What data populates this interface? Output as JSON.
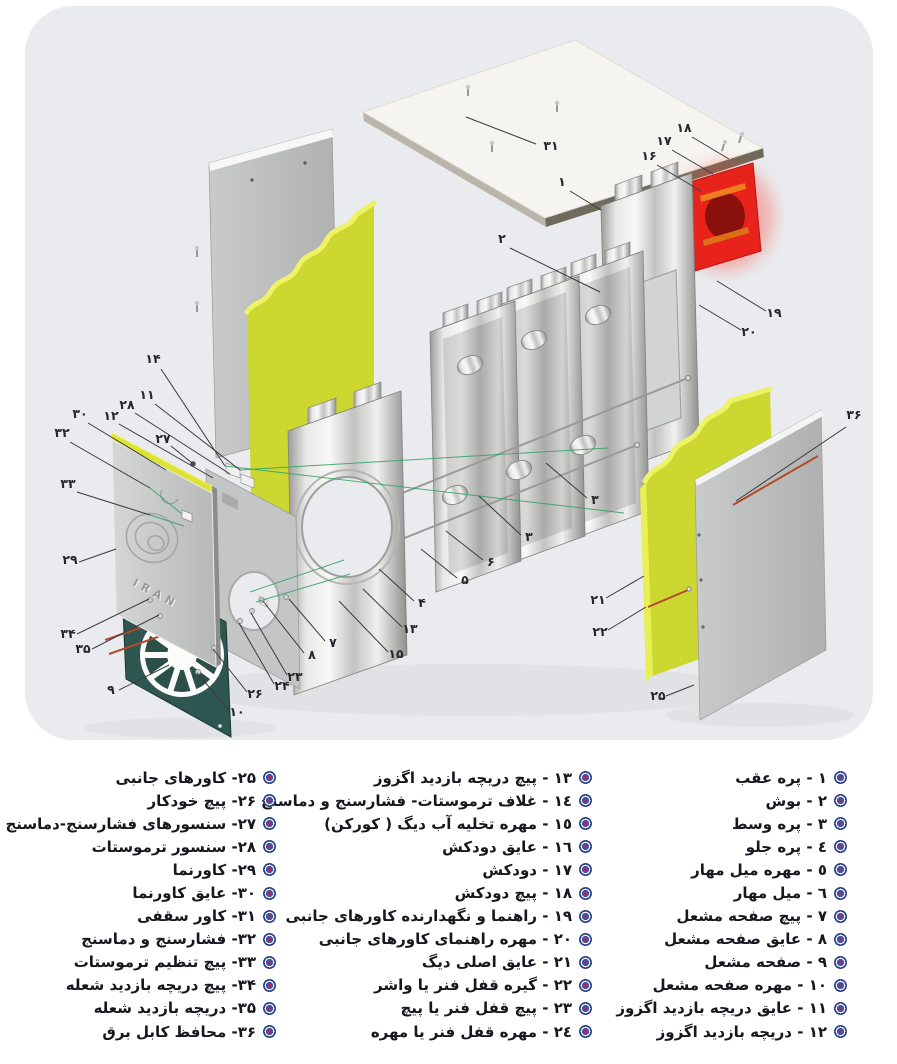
{
  "illustration": {
    "background_color": "#e9ebee",
    "logo_text": "IRAN",
    "colors": {
      "insulation_yellow": "#ccd72f",
      "insulation_highlight": "#eef263",
      "chimney_red": "#e8231b",
      "chimney_hole_dark": "#8a100c",
      "burner_plate_teal": "#2f5751",
      "panel_gray": "#bcbfbe",
      "cable_red": "#b34a28",
      "guide_green": "#2fa263",
      "callout_text": "#26262e"
    },
    "callouts": [
      {
        "n": "۳۱",
        "label": [
          551,
          150
        ],
        "line": [
          536,
          144,
          466,
          117
        ]
      },
      {
        "n": "۱۸",
        "label": [
          684,
          132
        ],
        "line": [
          692,
          137,
          729,
          159
        ]
      },
      {
        "n": "۱۷",
        "label": [
          664,
          145
        ],
        "line": [
          672,
          150,
          713,
          174
        ]
      },
      {
        "n": "۱۶",
        "label": [
          649,
          160
        ],
        "line": [
          657,
          165,
          701,
          191
        ]
      },
      {
        "n": "۱",
        "label": [
          562,
          186
        ],
        "line": [
          570,
          191,
          601,
          210
        ]
      },
      {
        "n": "۲",
        "label": [
          502,
          243
        ],
        "line": [
          510,
          248,
          600,
          292
        ]
      },
      {
        "n": "۱۹",
        "label": [
          774,
          317
        ],
        "line": [
          766,
          311,
          717,
          281
        ]
      },
      {
        "n": "۲۰",
        "label": [
          749,
          336
        ],
        "line": [
          741,
          330,
          699,
          305
        ]
      },
      {
        "n": "۳۶",
        "label": [
          854,
          419
        ],
        "line": [
          846,
          427,
          736,
          501
        ]
      },
      {
        "n": "۱۴",
        "label": [
          153,
          363
        ],
        "line": [
          161,
          369,
          225,
          466
        ]
      },
      {
        "n": "۱۱",
        "label": [
          147,
          399
        ],
        "line": [
          155,
          404,
          240,
          470
        ]
      },
      {
        "n": "۲۸",
        "label": [
          127,
          409
        ],
        "line": [
          135,
          413,
          230,
          474
        ]
      },
      {
        "n": "۱۲",
        "label": [
          111,
          420
        ],
        "line": [
          119,
          424,
          213,
          478
        ]
      },
      {
        "n": "۲۷",
        "label": [
          163,
          443
        ],
        "line": [
          171,
          446,
          192,
          463
        ]
      },
      {
        "n": "۳۰",
        "label": [
          80,
          418
        ],
        "line": [
          88,
          423,
          166,
          470
        ]
      },
      {
        "n": "۳۲",
        "label": [
          62,
          437
        ],
        "line": [
          70,
          442,
          150,
          488
        ]
      },
      {
        "n": "۳۳",
        "label": [
          68,
          488
        ],
        "line": [
          77,
          492,
          150,
          515
        ]
      },
      {
        "n": "۲۹",
        "label": [
          70,
          564
        ],
        "line": [
          79,
          562,
          116,
          549
        ]
      },
      {
        "n": "۳۴",
        "label": [
          68,
          638
        ],
        "line": [
          77,
          634,
          149,
          599
        ]
      },
      {
        "n": "۳۵",
        "label": [
          83,
          653
        ],
        "line": [
          92,
          649,
          159,
          615
        ]
      },
      {
        "n": "۹",
        "label": [
          111,
          694
        ],
        "line": [
          119,
          690,
          169,
          665
        ]
      },
      {
        "n": "۱۰",
        "label": [
          237,
          716
        ],
        "line": [
          229,
          710,
          197,
          673
        ]
      },
      {
        "n": "۲۶",
        "label": [
          255,
          698
        ],
        "line": [
          247,
          692,
          213,
          649
        ]
      },
      {
        "n": "۲۴",
        "label": [
          282,
          690
        ],
        "line": [
          274,
          684,
          239,
          623
        ]
      },
      {
        "n": "۲۳",
        "label": [
          295,
          681
        ],
        "line": [
          287,
          675,
          251,
          613
        ]
      },
      {
        "n": "۸",
        "label": [
          312,
          659
        ],
        "line": [
          304,
          653,
          263,
          601
        ]
      },
      {
        "n": "۷",
        "label": [
          333,
          647
        ],
        "line": [
          325,
          641,
          289,
          599
        ]
      },
      {
        "n": "۴",
        "label": [
          422,
          607
        ],
        "line": [
          414,
          601,
          379,
          569
        ]
      },
      {
        "n": "۱۳",
        "label": [
          410,
          633
        ],
        "line": [
          402,
          627,
          363,
          589
        ]
      },
      {
        "n": "۱۵",
        "label": [
          396,
          658
        ],
        "line": [
          388,
          652,
          339,
          601
        ]
      },
      {
        "n": "۵",
        "label": [
          465,
          584
        ],
        "line": [
          457,
          578,
          421,
          549
        ]
      },
      {
        "n": "۶",
        "label": [
          491,
          566
        ],
        "line": [
          483,
          560,
          446,
          531
        ]
      },
      {
        "n": "۳",
        "label": [
          595,
          504
        ],
        "line": [
          587,
          498,
          546,
          463
        ]
      },
      {
        "n": "۳",
        "label": [
          529,
          541
        ],
        "line": [
          521,
          535,
          479,
          496
        ]
      },
      {
        "n": "۲۱",
        "label": [
          598,
          604
        ],
        "line": [
          606,
          598,
          644,
          576
        ]
      },
      {
        "n": "۲۲",
        "label": [
          600,
          636
        ],
        "line": [
          608,
          630,
          646,
          607
        ]
      },
      {
        "n": "۲۵",
        "label": [
          658,
          700
        ],
        "line": [
          666,
          696,
          694,
          685
        ]
      }
    ]
  },
  "parts_list": {
    "text_color": "#17171f",
    "columns": [
      {
        "id": "items-1-12",
        "items": [
          "١ - پره عقب",
          "٢ - بوش",
          "٣ - پره وسط",
          "٤ - پره جلو",
          "٥ - مهره میل مهار",
          "٦ - میل مهار",
          "٧ - پیچ صفحه مشعل",
          "٨ - عایق صفحه مشعل",
          "٩ - صفحه مشعل",
          "١٠ - مهره صفحه مشعل",
          "١١ - عایق دریچه بازدید اگزوز",
          "١٢ - دریچه بازدید اگزوز"
        ]
      },
      {
        "id": "items-13-24",
        "items": [
          "١٣ - پیچ دریچه بازدید اگزوز",
          "١٤ - غلاف ترموستات- فشارسنج و دماسنج",
          "١٥ - مهره تخلیه آب دیگ ( کورکن)",
          "١٦ - عایق دودکش",
          "١٧ - دودکش",
          "١٨ - پیچ دودکش",
          "١٩ - راهنما و نگهدارنده کاورهای جانبی",
          "٢٠ - مهره راهنمای کاورهای جانبی",
          "٢١ - عایق اصلی دیگ",
          "٢٢ - گیره قفل فنر یا واشر",
          "٢٣ - پیچ قفل فنر یا پیچ",
          "٢٤ - مهره قفل فنر یا مهره"
        ]
      },
      {
        "id": "items-25-36",
        "items": [
          "۲۵- کاورهای جانبی",
          "۲۶- پیچ خودکار",
          "۲۷- سنسورهای فشارسنج-دماسنج",
          "۲۸- سنسور ترموستات",
          "۲۹- کاورنما",
          "۳۰- عایق کاورنما",
          "۳۱- کاور سقفی",
          "۳۲- فشارسنج و دماسنج",
          "۳۳- پیچ تنظیم ترموستات",
          "۳۴- پیچ دریچه بازدید شعله",
          "۳۵- دریچه بازدید شعله",
          "۳۶- محافظ کابل برق"
        ]
      }
    ]
  }
}
